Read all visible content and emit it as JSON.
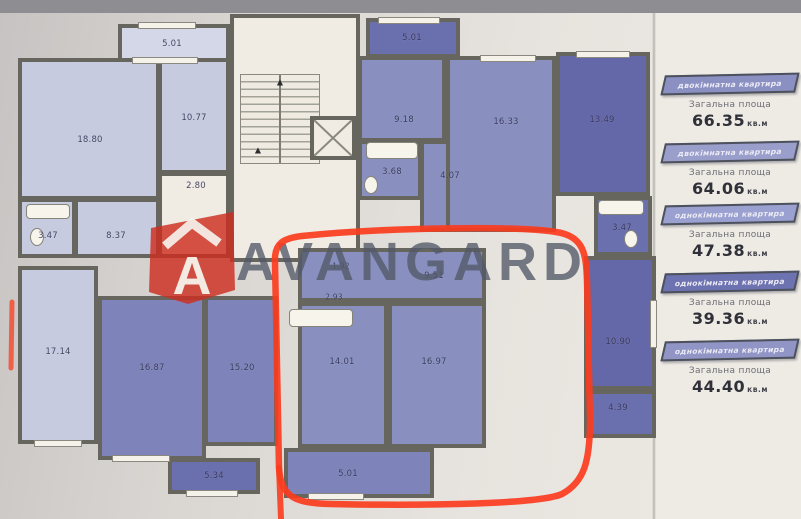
{
  "watermark": {
    "brand": "AVANGARD",
    "logo_letter": "A"
  },
  "icons": {
    "stairs_arrow": "▲"
  },
  "plan": {
    "labels": {
      "tl_balcony": "5.01",
      "tl_room_1": "18.80",
      "tl_room_2": "10.77",
      "tl_entry": "2.80",
      "tl_bath": "3.47",
      "tl_hall": "8.37",
      "ml_room": "17.14",
      "bl_room_1": "16.87",
      "bl_room_2": "15.20",
      "bl_balcony": "5.34",
      "tm_balcony": "5.01",
      "tm_room_1": "9.18",
      "tm_bath": "3.68",
      "tm_hall": "4.07",
      "tm_room_2": "16.33",
      "tr_room": "13.49",
      "r_bath": "3.47",
      "r_room": "10.90",
      "r_small": "4.39",
      "c_hall": "9.51",
      "c_ward_1": "1.92",
      "c_ward_2": "2.93",
      "c_room_1": "14.01",
      "c_room_2": "16.97",
      "c_balcony": "5.01"
    }
  },
  "legend": {
    "items": [
      {
        "type": "двокімнатна квартира",
        "area_label": "Загальна площа",
        "value": "66.35",
        "unit": "кв.м",
        "banner_color": "#8a90c2"
      },
      {
        "type": "двокімнатна квартира",
        "area_label": "Загальна площа",
        "value": "64.06",
        "unit": "кв.м",
        "banner_color": "#999ecb"
      },
      {
        "type": "однокімнатна квартира",
        "area_label": "Загальна площа",
        "value": "47.38",
        "unit": "кв.м",
        "banner_color": "#9aa0cf"
      },
      {
        "type": "однокімнатна квартира",
        "area_label": "Загальна площа",
        "value": "39.36",
        "unit": "кв.м",
        "banner_color": "#6d72b0"
      },
      {
        "type": "однокімнатна квартира",
        "area_label": "Загальна площа",
        "value": "44.40",
        "unit": "кв.м",
        "banner_color": "#9095c6"
      }
    ]
  },
  "colors": {
    "marker_red": "#fb3c1e",
    "logo_red": "#cd2d22",
    "wall": "#67665e",
    "room_light": "#c6cbdf",
    "room_medium": "#8990bf",
    "room_dark": "#6a6fae"
  }
}
